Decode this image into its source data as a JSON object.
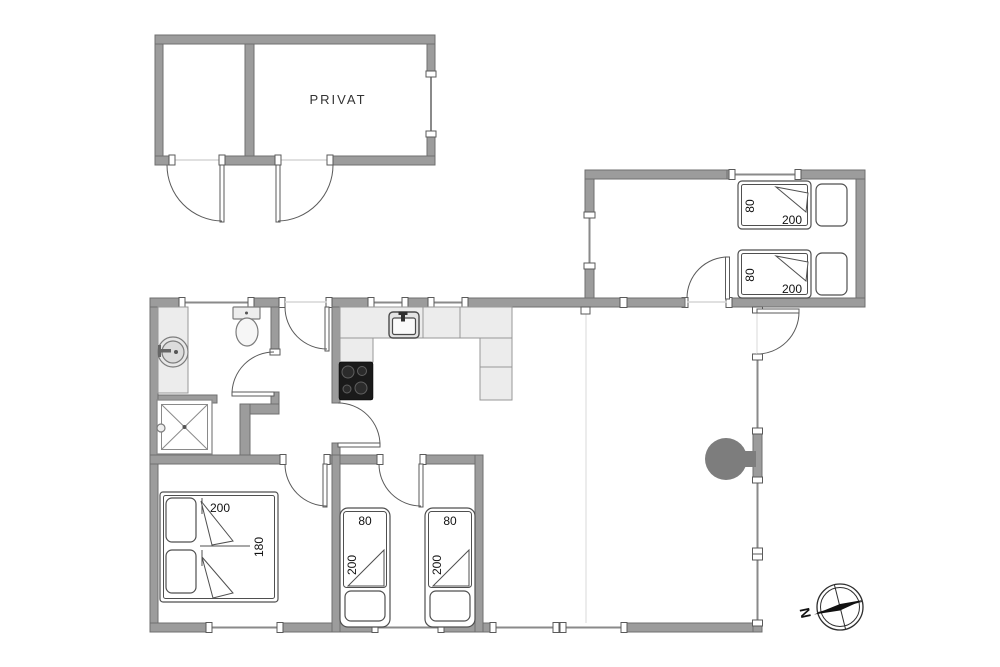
{
  "labels": {
    "privat_room": "PRIVAT",
    "compass_north": "N"
  },
  "beds": {
    "annex_bed_1": {
      "width_cm": "80",
      "length_cm": "200"
    },
    "annex_bed_2": {
      "width_cm": "80",
      "length_cm": "200"
    },
    "master_double_bed": {
      "length_cm": "200",
      "width_cm": "180"
    },
    "single_bed_1": {
      "width_cm": "80",
      "length_cm": "200"
    },
    "single_bed_2": {
      "width_cm": "80",
      "length_cm": "200"
    }
  },
  "colors": {
    "wall_fill": "#9c9c9c",
    "wall_stroke": "#6f6f6f",
    "counter_fill": "#ececec",
    "stove_fill": "#1a1a1a",
    "fireplace_fill": "#7d7d7d"
  }
}
